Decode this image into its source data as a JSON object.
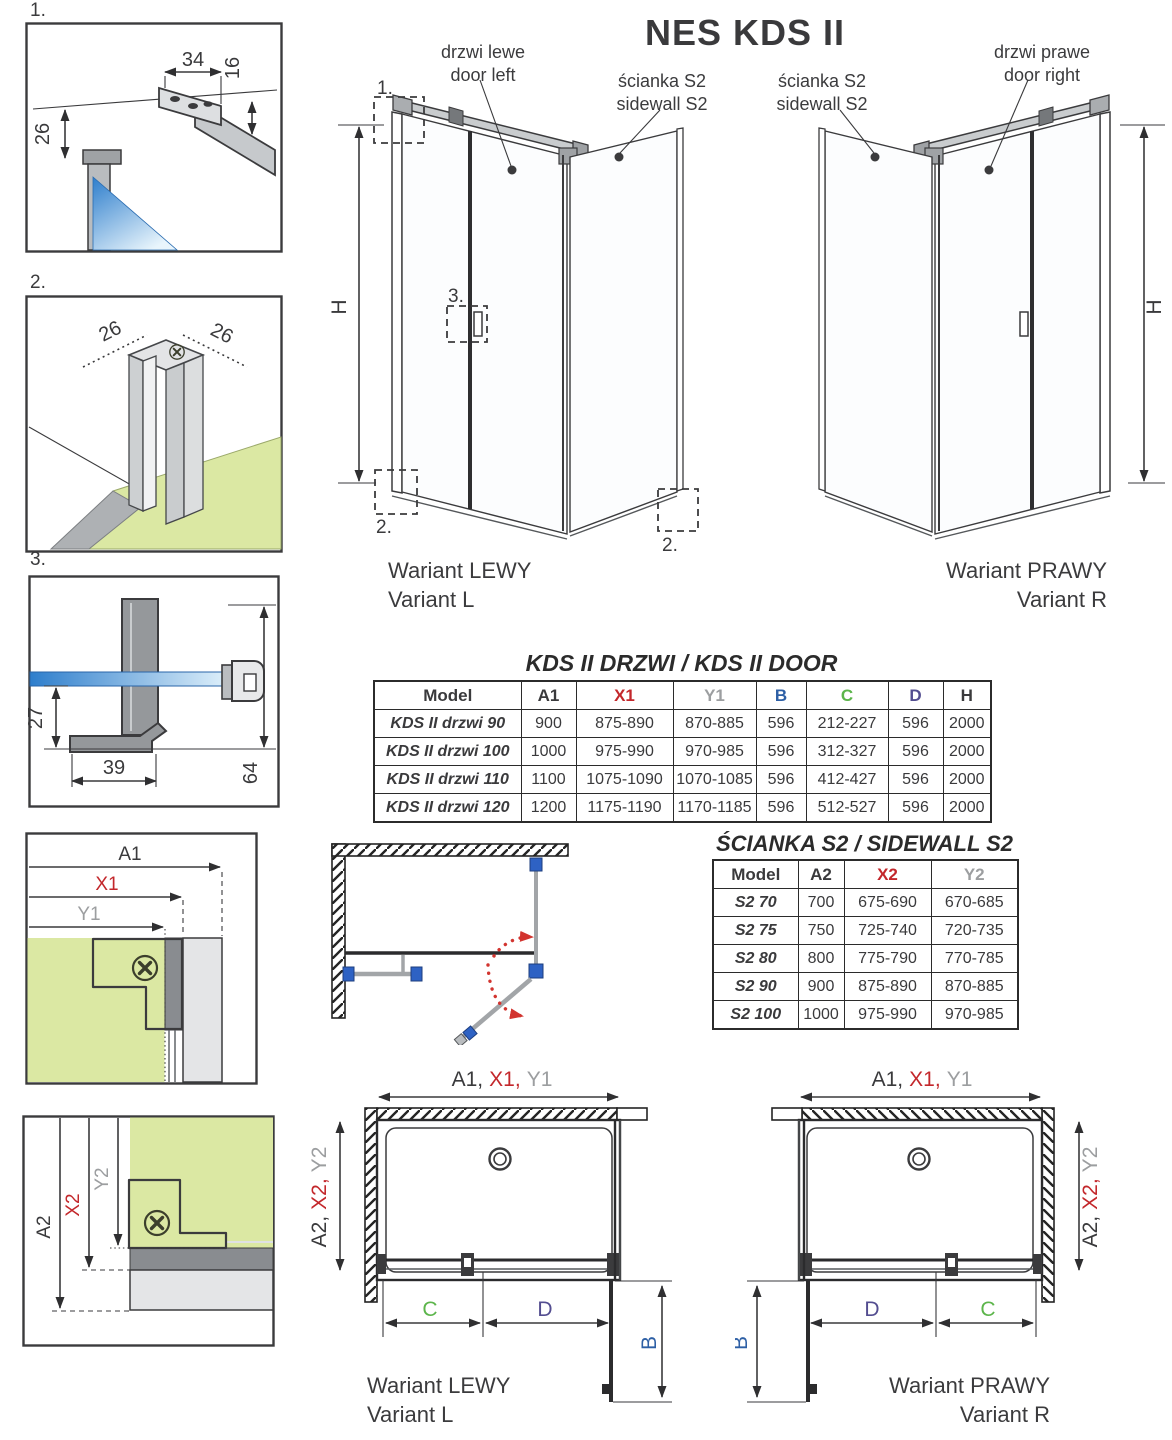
{
  "page_title": "NES KDS II",
  "top_labels": {
    "door_left": {
      "line1": "drzwi lewe",
      "line2": "door left"
    },
    "sidewall_left": {
      "line1": "ścianka S2",
      "line2": "sidewall S2"
    },
    "sidewall_right": {
      "line1": "ścianka S2",
      "line2": "sidewall S2"
    },
    "door_right": {
      "line1": "drzwi prawe",
      "line2": "door right"
    }
  },
  "details": {
    "d1": {
      "label": "1.",
      "dim_width": "34",
      "dim_height": "16",
      "dim_offset": "26"
    },
    "d2": {
      "label": "2.",
      "dim_left": "26",
      "dim_right": "26"
    },
    "d3": {
      "label": "3.",
      "dim_glass_to_foot": "27",
      "dim_foot": "39",
      "dim_total": "64"
    }
  },
  "dims": {
    "h": "H",
    "b": "B",
    "c": "C",
    "d": "D",
    "a1": "A1",
    "x1": "X1",
    "y1": "Y1",
    "a2": "A2",
    "x2": "X2",
    "y2": "Y2",
    "a1_group": [
      "A1,",
      "X1,",
      "Y1"
    ],
    "a2_group": [
      "A2,",
      "X2,",
      "Y2"
    ]
  },
  "variants": {
    "left": {
      "line1": "Wariant LEWY",
      "line2": "Variant L"
    },
    "right": {
      "line1": "Wariant PRAWY",
      "line2": "Variant R"
    }
  },
  "door_table": {
    "title": "KDS II DRZWI / KDS II DOOR",
    "headers": [
      "Model",
      "A1",
      "X1",
      "Y1",
      "B",
      "C",
      "D",
      "H"
    ],
    "rows": [
      [
        "KDS II drzwi 90",
        "900",
        "875-890",
        "870-885",
        "596",
        "212-227",
        "596",
        "2000"
      ],
      [
        "KDS II drzwi 100",
        "1000",
        "975-990",
        "970-985",
        "596",
        "312-327",
        "596",
        "2000"
      ],
      [
        "KDS II drzwi 110",
        "1100",
        "1075-1090",
        "1070-1085",
        "596",
        "412-427",
        "596",
        "2000"
      ],
      [
        "KDS II drzwi 120",
        "1200",
        "1175-1190",
        "1170-1185",
        "596",
        "512-527",
        "596",
        "2000"
      ]
    ]
  },
  "sidewall_table": {
    "title": "ŚCIANKA S2 / SIDEWALL S2",
    "headers": [
      "Model",
      "A2",
      "X2",
      "Y2"
    ],
    "rows": [
      [
        "S2 70",
        "700",
        "675-690",
        "670-685"
      ],
      [
        "S2 75",
        "750",
        "725-740",
        "720-735"
      ],
      [
        "S2 80",
        "800",
        "775-790",
        "770-785"
      ],
      [
        "S2 90",
        "900",
        "875-890",
        "870-885"
      ],
      [
        "S2 100",
        "1000",
        "975-990",
        "970-985"
      ]
    ]
  },
  "icons": {
    "screw": "flat-head-screw",
    "drain": "shower-drain"
  },
  "colors": {
    "accent_red": "#c3272b",
    "accent_gray": "#9c9ea0",
    "accent_blue": "#2d5fa5",
    "accent_green": "#5cb54b",
    "accent_purple": "#534d90",
    "line_dark": "#3a3a3c",
    "floor_green": "#dbe8a3",
    "glass_blue": "#2e7ecc"
  }
}
